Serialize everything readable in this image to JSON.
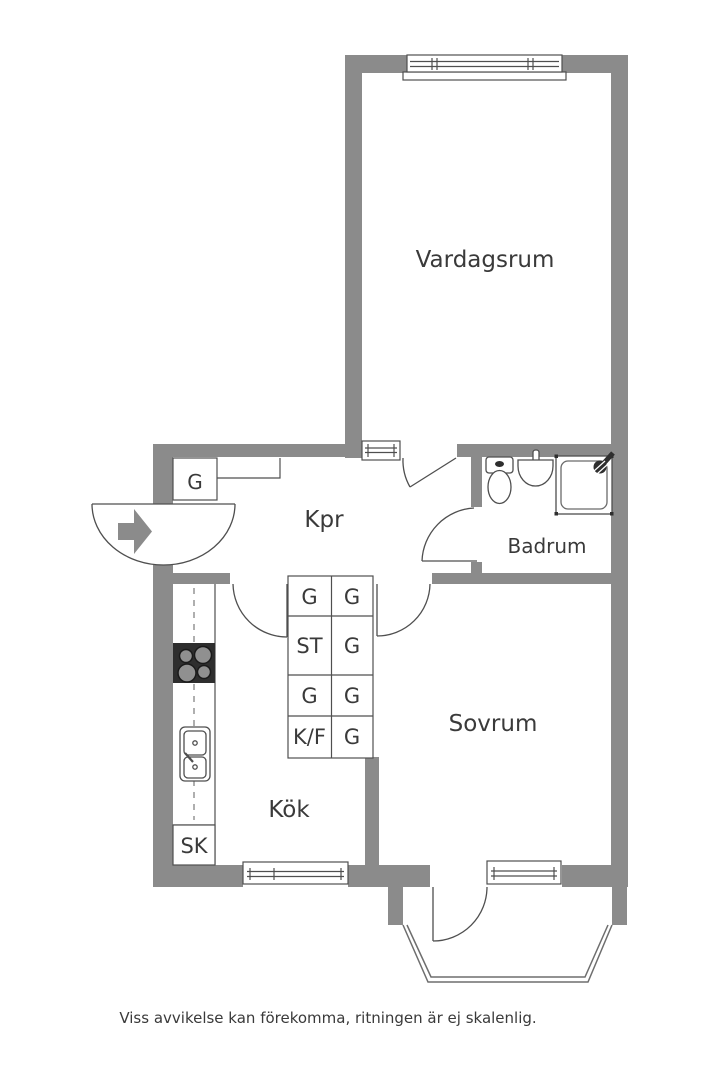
{
  "floorplan": {
    "rooms": {
      "living_room": "Vardagsrum",
      "hallway": "Kpr",
      "bathroom": "Badrum",
      "bedroom": "Sovrum",
      "kitchen": "Kök"
    },
    "closets": {
      "hall_closet": "G",
      "cleaning_closet": "SK"
    },
    "cabinets": {
      "cells": [
        "G",
        "G",
        "ST",
        "G",
        "G",
        "G",
        "K/F",
        "G"
      ]
    },
    "icons": {
      "entrance_arrow": "right-arrow"
    }
  },
  "footer": {
    "disclaimer": "Viss avvikelse kan förekomma, ritningen är ej skalenlig."
  },
  "colors": {
    "wall": "#8b8b8b",
    "line": "#4f4f4f",
    "line_light": "#6e6e6e",
    "text": "#3a3a3a",
    "fixture_dark": "#2e2e2e",
    "burner": "#909090",
    "white": "#ffffff"
  }
}
